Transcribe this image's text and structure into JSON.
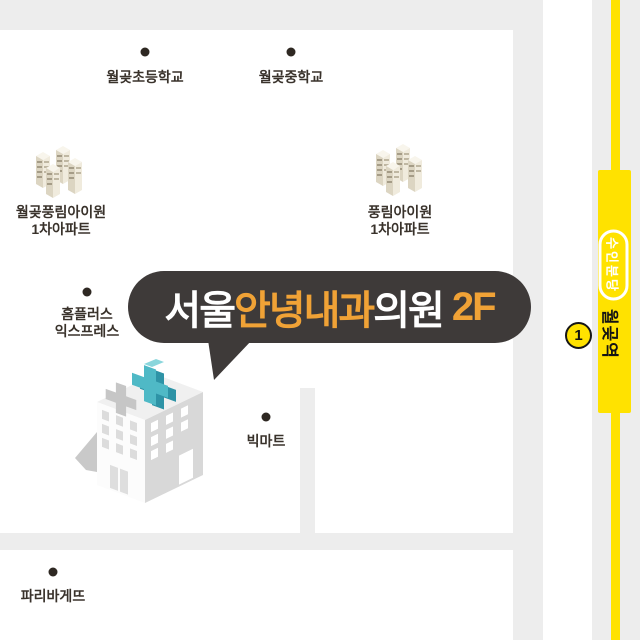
{
  "map": {
    "background_color": "#FFFFFF",
    "road_color": "#EDEDED",
    "label_text_color": "#39322B",
    "pois": {
      "elementary_school": {
        "label": "월곶초등학교"
      },
      "middle_school": {
        "label": "월곶중학교"
      },
      "apartment_left": {
        "line1": "월곶풍림아이원",
        "line2": "1차아파트"
      },
      "apartment_right": {
        "line1": "풍림아이원",
        "line2": "1차아파트"
      },
      "homeplus": {
        "line1": "홈플러스",
        "line2": "익스프레스"
      },
      "bigmart": {
        "label": "빅마트"
      },
      "paris_baguette": {
        "label": "파리바게뜨"
      }
    },
    "clinic": {
      "bubble_bg": "#3E3A39",
      "accent_color": "#F0A236",
      "segments": [
        {
          "text": "서울",
          "color": "#FFFFFF"
        },
        {
          "text": "안녕내과",
          "color": "#F0A236"
        },
        {
          "text": "의원",
          "color": "#FFFFFF"
        },
        {
          "text": " 2F",
          "color": "#F0A236"
        }
      ],
      "cross_color": "#4FB9C6"
    },
    "subway": {
      "line_badge": "수인분당",
      "station_name": "월곶역",
      "exit_number": "1",
      "line_color": "#FFE200"
    }
  }
}
